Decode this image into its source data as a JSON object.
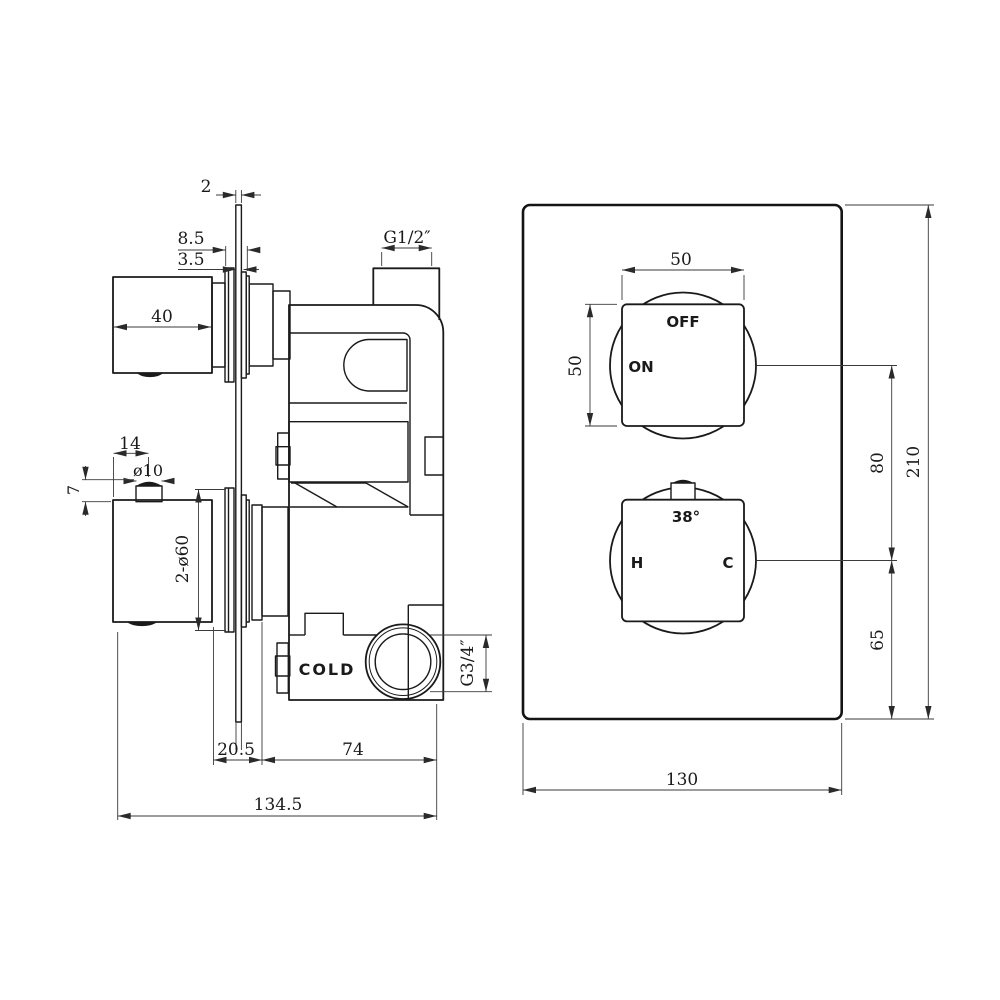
{
  "drawing": {
    "background": "#ffffff",
    "line_color": "#1a1a1a",
    "views": {
      "side": {
        "plate_thickness": "2",
        "depth_a": "8.5",
        "depth_b": "3.5",
        "outlet_thread": "G1/2″",
        "knob_depth": "40",
        "pin_offset": "14",
        "pin_dia": "ø10",
        "pin_height": "7",
        "escutcheon_dia": "2-ø60",
        "cold_label": "COLD",
        "inlet_thread": "G3/4″",
        "plate_to_body": "20.5",
        "body_depth": "74",
        "total_depth": "134.5"
      },
      "front": {
        "knob_width": "50",
        "knob_height": "50",
        "off_label": "OFF",
        "on_label": "ON",
        "temp_label": "38°",
        "hot_label": "H",
        "cold_label": "C",
        "knob_spacing": "80",
        "bottom_offset": "65",
        "plate_height": "210",
        "plate_width": "130"
      }
    }
  }
}
